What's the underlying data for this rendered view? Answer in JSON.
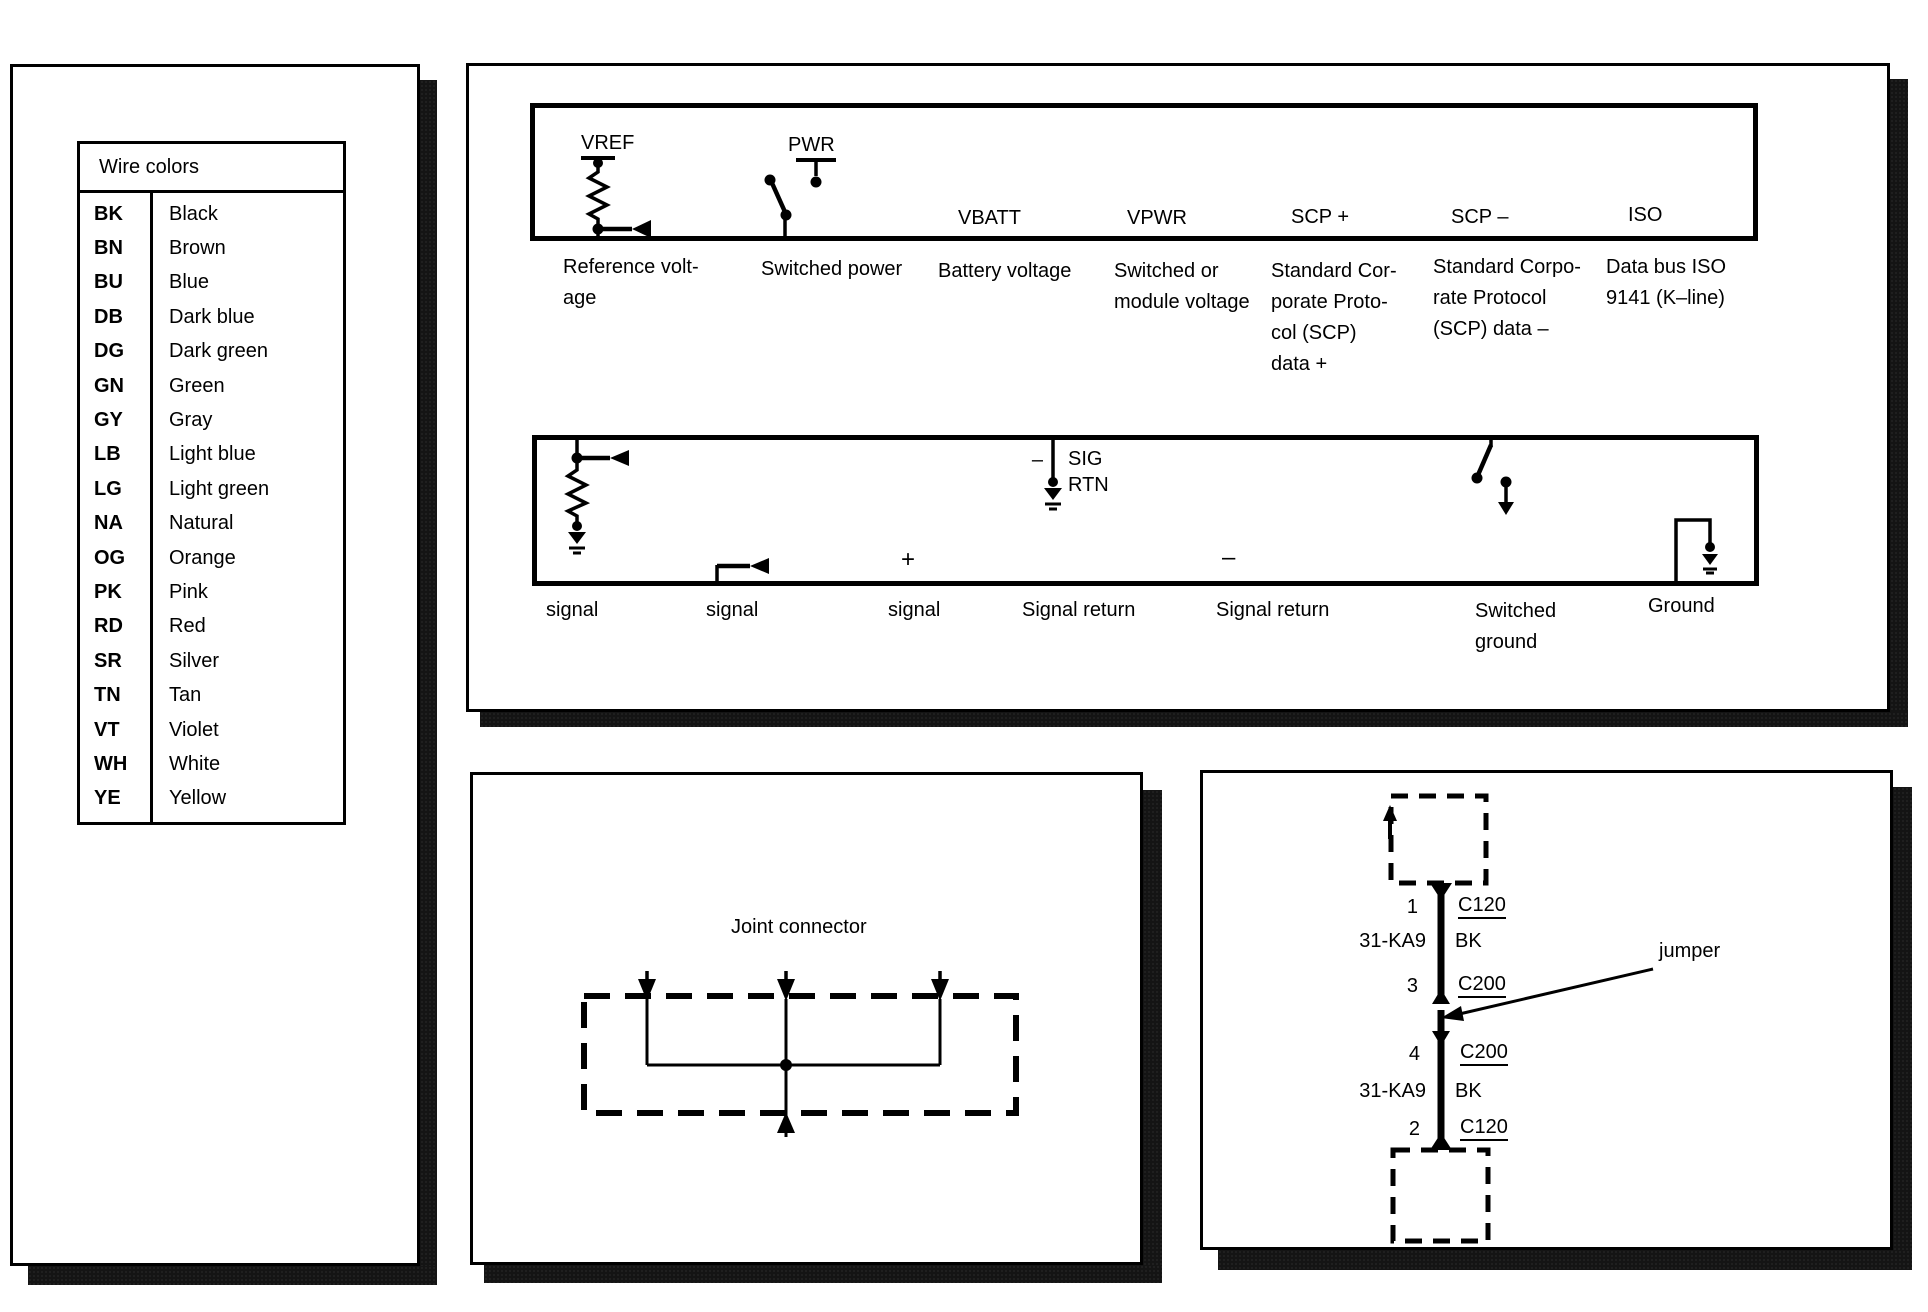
{
  "page": {
    "background": "#ffffff",
    "ink": "#000000",
    "shadow": "#141414"
  },
  "wire_colors": {
    "title": "Wire colors",
    "entries": [
      {
        "code": "BK",
        "name": "Black"
      },
      {
        "code": "BN",
        "name": "Brown"
      },
      {
        "code": "BU",
        "name": "Blue"
      },
      {
        "code": "DB",
        "name": "Dark blue"
      },
      {
        "code": "DG",
        "name": "Dark green"
      },
      {
        "code": "GN",
        "name": "Green"
      },
      {
        "code": "GY",
        "name": "Gray"
      },
      {
        "code": "LB",
        "name": "Light blue"
      },
      {
        "code": "LG",
        "name": "Light green"
      },
      {
        "code": "NA",
        "name": "Natural"
      },
      {
        "code": "OG",
        "name": "Orange"
      },
      {
        "code": "PK",
        "name": "Pink"
      },
      {
        "code": "RD",
        "name": "Red"
      },
      {
        "code": "SR",
        "name": "Silver"
      },
      {
        "code": "TN",
        "name": "Tan"
      },
      {
        "code": "VT",
        "name": "Violet"
      },
      {
        "code": "WH",
        "name": "White"
      },
      {
        "code": "YE",
        "name": "Yellow"
      }
    ]
  },
  "symbol_legend": {
    "row1": {
      "items": [
        {
          "label": "VREF",
          "desc": "Reference volt-\nage"
        },
        {
          "label": "PWR",
          "desc": "Switched power"
        },
        {
          "label": "VBATT",
          "desc": "Battery voltage"
        },
        {
          "label": "VPWR",
          "desc": "Switched or\nmodule voltage"
        },
        {
          "label": "SCP +",
          "desc": "Standard Cor-\nporate Proto-\ncol (SCP)\ndata +"
        },
        {
          "label": "SCP –",
          "desc": "Standard Corpo-\nrate Protocol\n(SCP) data –"
        },
        {
          "label": "ISO",
          "desc": "Data bus ISO\n9141 (K–line)"
        }
      ]
    },
    "row2": {
      "sig_label": "SIG",
      "rtn_label": "RTN",
      "minus": "–",
      "plus": "+",
      "minus2": "–",
      "labels": [
        "signal",
        "signal",
        "signal",
        "Signal return",
        "Signal return",
        "Switched\nground",
        "Ground"
      ]
    }
  },
  "joint_connector": {
    "title": "Joint connector"
  },
  "jumper_diagram": {
    "annotation": "jumper",
    "seg1": {
      "pin": "1",
      "connector": "C120",
      "circuit": "31-KA9",
      "color": "BK",
      "pin2": "3",
      "connector2": "C200"
    },
    "seg2": {
      "pin": "4",
      "connector": "C200",
      "circuit": "31-KA9",
      "color": "BK",
      "pin2": "2",
      "connector2": "C120"
    }
  }
}
